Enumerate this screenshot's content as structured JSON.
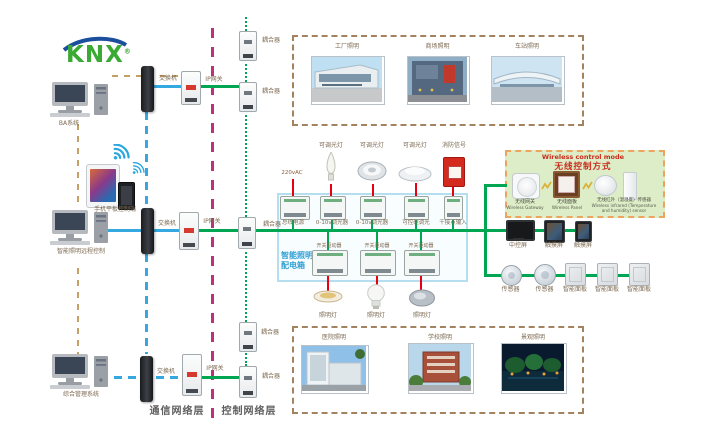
{
  "brand": {
    "name": "KNX",
    "registered": "®"
  },
  "layers": {
    "comm": "通信网络层",
    "control": "控制网络层"
  },
  "terminals": {
    "ba": "BA系统",
    "mobile": "手机平板控制端",
    "remote": "智能照明远程控制",
    "mgmt": "综合管理系统"
  },
  "net": {
    "switches": [
      "交换机",
      "交换机",
      "交换机"
    ],
    "gateways": [
      "IP网关",
      "IP网关",
      "IP网关"
    ],
    "couplers": [
      "耦合器",
      "耦合器",
      "耦合器",
      "耦合器",
      "耦合器"
    ]
  },
  "scenes_top": [
    {
      "label": "工厂照明"
    },
    {
      "label": "商场照明"
    },
    {
      "label": "车站照明"
    }
  ],
  "scenes_bottom": [
    {
      "label": "医院照明"
    },
    {
      "label": "学校照明"
    },
    {
      "label": "景观照明"
    }
  ],
  "distbox": {
    "title1": "智能照明",
    "title2": "配电箱",
    "power": "220vAC",
    "top_modules": [
      "总线电源",
      "0-10v调光器",
      "0-10v调光器",
      "可控硅调光",
      "干接点输入"
    ],
    "bottom_modules": [
      "开关驱动器",
      "开关驱动器",
      "开关驱动器"
    ],
    "top_loads": [
      "可调光灯",
      "可调光灯",
      "可调光灯",
      "消防信号"
    ],
    "bottom_loads": [
      "照明灯",
      "照明灯",
      "照明灯"
    ]
  },
  "wireless": {
    "title_en": "Wireless control mode",
    "title_zh": "无线控制方式",
    "devices": [
      {
        "zh": "无线网关",
        "en": "Wireless Gateway"
      },
      {
        "zh": "无线面板",
        "en": "Wireless Panel"
      },
      {
        "zh": "无线红外（温湿度）传感器",
        "en": "Wireless infrared (Temperature and humidity) sensor"
      }
    ]
  },
  "panel_row1": [
    "中控屏",
    "触摸屏",
    "触摸屏"
  ],
  "panel_row2": [
    "传感器",
    "传感器",
    "智能面板",
    "智能面板",
    "智能面板"
  ],
  "colors": {
    "bus_green": "#00a651",
    "comm_blue": "#35a8e0",
    "layer_magenta": "#bf2f7b",
    "link_tan": "#c3a164",
    "load_red": "#e60012",
    "photo_border_brown": "#a5825f",
    "wireless_bg": "#dcedc8",
    "wireless_border": "#eca45e",
    "distribution_border": "#b5def0",
    "knx_green": "#3aaa35",
    "knx_blue": "#1b4f9c"
  }
}
